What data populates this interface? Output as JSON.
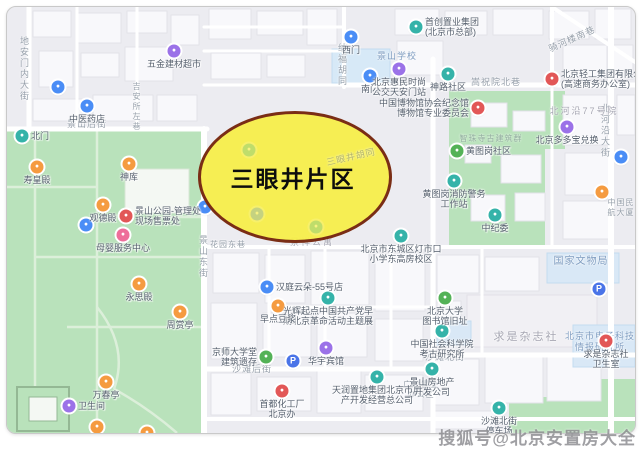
{
  "page": {
    "watermark": "搜狐号@北京安置房大全"
  },
  "highlight": {
    "label": "三眼井片区",
    "fill": "#F7EE4A",
    "border": "#7A2D15"
  },
  "colors": {
    "blue": "#4A8DF6",
    "pblue": "#4A74E8",
    "teal": "#35B3A9",
    "green": "#54B257",
    "purple": "#9B72E8",
    "orange": "#F59B40",
    "red": "#E25757",
    "pink": "#EE6E9A"
  },
  "map": {
    "pois": [
      {
        "x": 59,
        "y": 88,
        "c": "blue",
        "lines": []
      },
      {
        "x": 88,
        "y": 107,
        "c": "blue",
        "lines": [
          "中医药店"
        ]
      },
      {
        "x": 175,
        "y": 52,
        "c": "purple",
        "lines": [
          "五金建材超市"
        ]
      },
      {
        "x": 352,
        "y": 38,
        "c": "blue",
        "lines": [
          "西门"
        ]
      },
      {
        "x": 417,
        "y": 28,
        "c": "teal",
        "side": "right",
        "lines": [
          "首创置业集团",
          "(北京市总部)"
        ]
      },
      {
        "x": 371,
        "y": 77,
        "c": "blue",
        "lines": [
          "南门"
        ]
      },
      {
        "x": 400,
        "y": 70,
        "c": "purple",
        "lines": [
          "北京惠民时尚",
          "公交天安门站"
        ]
      },
      {
        "x": 449,
        "y": 75,
        "c": "teal",
        "lines": [
          "神路社区"
        ]
      },
      {
        "x": 479,
        "y": 109,
        "c": "red",
        "side": "left",
        "lines": [
          "中国博物馆协会纪念馆",
          "博物馆专业委员会"
        ]
      },
      {
        "x": 553,
        "y": 80,
        "c": "red",
        "side": "right",
        "lines": [
          "北京轻工集团有限公司",
          "(高速商务办公室)"
        ]
      },
      {
        "x": 458,
        "y": 152,
        "c": "green",
        "side": "right",
        "lines": [
          "黄图岗社区"
        ]
      },
      {
        "x": 455,
        "y": 182,
        "c": "teal",
        "lines": [
          "黄图岗消防警务",
          "工作站"
        ]
      },
      {
        "x": 568,
        "y": 128,
        "c": "purple",
        "lines": [
          "北京多多宝兑换"
        ]
      },
      {
        "x": 622,
        "y": 158,
        "c": "blue",
        "lines": []
      },
      {
        "x": 603,
        "y": 193,
        "c": "orange",
        "lines": []
      },
      {
        "x": 600,
        "y": 290,
        "c": "pblue",
        "glyph": "P",
        "lines": []
      },
      {
        "x": 294,
        "y": 362,
        "c": "pblue",
        "glyph": "P",
        "lines": []
      },
      {
        "x": 206,
        "y": 208,
        "c": "blue",
        "lines": []
      },
      {
        "x": 87,
        "y": 226,
        "c": "blue",
        "lines": []
      },
      {
        "x": 496,
        "y": 216,
        "c": "teal",
        "lines": [
          "中纪委"
        ]
      },
      {
        "x": 402,
        "y": 237,
        "c": "teal",
        "lines": [
          "北京市东城区灯市口",
          "小学东高房校区"
        ]
      },
      {
        "x": 329,
        "y": 299,
        "c": "teal",
        "lines": [
          "光辉起点中国共产党早",
          "期北京革命活动主题展"
        ]
      },
      {
        "x": 268,
        "y": 288,
        "c": "blue",
        "side": "right",
        "lines": [
          "汉庭云朵-55号店"
        ]
      },
      {
        "x": 279,
        "y": 307,
        "c": "orange",
        "lines": [
          "早点豆浆"
        ]
      },
      {
        "x": 267,
        "y": 358,
        "c": "green",
        "side": "left",
        "lines": [
          "京师大学堂",
          "建筑遗存"
        ]
      },
      {
        "x": 327,
        "y": 349,
        "c": "purple",
        "lines": [
          "华宇宾馆"
        ]
      },
      {
        "x": 283,
        "y": 392,
        "c": "red",
        "lines": [
          "首都化工厂",
          "北京办"
        ]
      },
      {
        "x": 378,
        "y": 378,
        "c": "teal",
        "lines": [
          "天润置地集团北京市房",
          "产开发经营总公司"
        ]
      },
      {
        "x": 443,
        "y": 332,
        "c": "teal",
        "lines": [
          "中国社会科学院",
          "考古研究所"
        ]
      },
      {
        "x": 446,
        "y": 299,
        "c": "green",
        "lines": [
          "北京大学",
          "图书馆旧址"
        ]
      },
      {
        "x": 433,
        "y": 370,
        "c": "teal",
        "lines": [
          "景山房地产",
          "开发公司"
        ]
      },
      {
        "x": 607,
        "y": 342,
        "c": "red",
        "lines": [
          "求是杂志社",
          "卫生室"
        ]
      },
      {
        "x": 500,
        "y": 409,
        "c": "teal",
        "lines": [
          "沙滩北街",
          "停车场"
        ]
      },
      {
        "x": 23,
        "y": 137,
        "c": "teal",
        "side": "right",
        "lines": [
          "北门"
        ]
      },
      {
        "x": 38,
        "y": 168,
        "c": "orange",
        "lines": [
          "寿皇殿"
        ]
      },
      {
        "x": 130,
        "y": 165,
        "c": "orange",
        "lines": [
          "神库"
        ]
      },
      {
        "x": 104,
        "y": 206,
        "c": "orange",
        "lines": [
          "观德殿"
        ]
      },
      {
        "x": 127,
        "y": 217,
        "c": "red",
        "side": "right",
        "lines": [
          "景山公园-管理处",
          "现场售票处"
        ]
      },
      {
        "x": 124,
        "y": 236,
        "c": "pink",
        "lines": [
          "母婴服务中心"
        ]
      },
      {
        "x": 140,
        "y": 285,
        "c": "orange",
        "lines": [
          "永思殿"
        ]
      },
      {
        "x": 181,
        "y": 313,
        "c": "orange",
        "lines": [
          "周赏亭"
        ]
      },
      {
        "x": 107,
        "y": 383,
        "c": "orange",
        "lines": [
          "万春亭"
        ]
      },
      {
        "x": 70,
        "y": 407,
        "c": "purple",
        "side": "right",
        "lines": [
          "卫生间"
        ]
      },
      {
        "x": 98,
        "y": 428,
        "c": "orange",
        "lines": []
      },
      {
        "x": 148,
        "y": 434,
        "c": "orange",
        "lines": []
      },
      {
        "x": 250,
        "y": 151,
        "c": "teal",
        "ghost": true,
        "lines": []
      },
      {
        "x": 317,
        "y": 228,
        "c": "teal",
        "ghost": true,
        "lines": []
      },
      {
        "x": 258,
        "y": 215,
        "c": "blue",
        "ghost": true,
        "lines": []
      }
    ],
    "labels": [
      {
        "x": 25,
        "y": 70,
        "t": "地安门内大街",
        "vertical": true
      },
      {
        "x": 88,
        "y": 125,
        "t": "景山后街"
      },
      {
        "x": 137,
        "y": 108,
        "t": "吉安所左巷",
        "vertical": true,
        "size": 8
      },
      {
        "x": 204,
        "y": 258,
        "t": "景山东街",
        "vertical": true
      },
      {
        "x": 343,
        "y": 66,
        "t": "纳福胡同",
        "vertical": true
      },
      {
        "x": 497,
        "y": 83,
        "t": "嵩祝院北巷"
      },
      {
        "x": 606,
        "y": 132,
        "t": "北河沿大街",
        "vertical": true
      },
      {
        "x": 573,
        "y": 40,
        "t": "骑河楼南巷",
        "rotate": -24
      },
      {
        "x": 253,
        "y": 370,
        "t": "沙滩后街"
      },
      {
        "x": 446,
        "y": 358,
        "t": "沙滩北街"
      },
      {
        "x": 229,
        "y": 246,
        "t": "花园东巷",
        "size": 8
      },
      {
        "x": 352,
        "y": 158,
        "t": "三眼井胡同",
        "rotate": -13,
        "kind": "faint"
      },
      {
        "x": 398,
        "y": 57,
        "t": "景山学校",
        "kind": "facility"
      },
      {
        "x": 313,
        "y": 243,
        "t": "景祥公寓",
        "kind": "area",
        "size": 9
      },
      {
        "x": 527,
        "y": 338,
        "t": "求是杂志社",
        "kind": "area",
        "size": 11
      },
      {
        "x": 585,
        "y": 112,
        "t": "北河沿77号院",
        "kind": "area",
        "size": 9
      },
      {
        "x": 582,
        "y": 263,
        "t": "国家文物局",
        "kind": "facility",
        "size": 10
      },
      {
        "x": 601,
        "y": 337,
        "t": "北京市电子科技",
        "kind": "facility"
      },
      {
        "x": 601,
        "y": 348,
        "t": "情报研究所",
        "kind": "facility"
      },
      {
        "x": 492,
        "y": 140,
        "t": "智珠寺古建筑群",
        "kind": "faint",
        "size": 8
      },
      {
        "x": 422,
        "y": 386,
        "t": "广发置业",
        "size": 8
      },
      {
        "x": 422,
        "y": 396,
        "t": "办公区",
        "size": 8
      },
      {
        "x": 622,
        "y": 204,
        "t": "中国民",
        "size": 8
      },
      {
        "x": 622,
        "y": 214,
        "t": "航大厦",
        "size": 8
      }
    ]
  }
}
